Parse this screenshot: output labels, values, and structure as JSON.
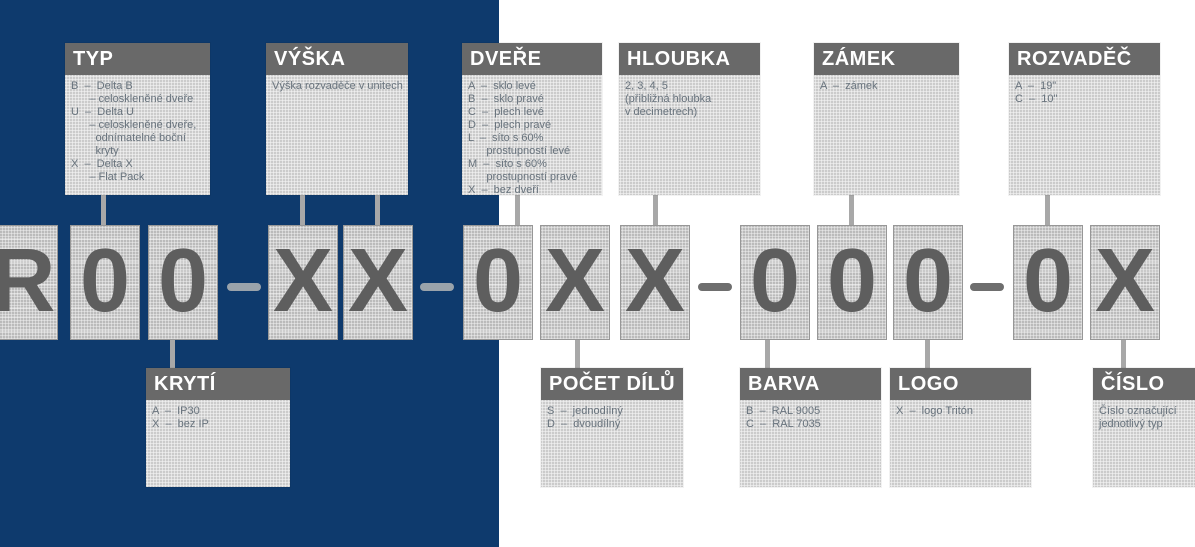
{
  "colors": {
    "background_left_panel": "#0e3a6d",
    "background_right": "#ffffff",
    "legend_header_bg": "#696969",
    "legend_header_text": "#ffffff",
    "legend_body_bg": "#d9d9d9",
    "legend_body_text": "#68737d",
    "code_box_bg": "#c9c9c9",
    "code_char": "#5e5e5e",
    "separator_on_blue": "#9aa3ab",
    "separator_on_white": "#6e6e6e",
    "connector": "#a8a8a8"
  },
  "legend_top": [
    {
      "title": "TYP",
      "lines": [
        "B  –  Delta B",
        "      – celoskleněné dveře",
        "U  –  Delta U",
        "      – celoskleněné dveře,",
        "        odnímatelné boční",
        "        kryty",
        "X  –  Delta X",
        "      – Flat Pack"
      ]
    },
    {
      "title": "VÝŠKA",
      "lines": [
        "Výška rozvaděče v unitech"
      ]
    },
    {
      "title": "DVEŘE",
      "lines": [
        "A  –  sklo levé",
        "B  –  sklo pravé",
        "C  –  plech levé",
        "D  –  plech pravé",
        "L  –  síto s 60%",
        "      prostupností levé",
        "M  –  síto s 60%",
        "      prostupností pravé",
        "X  –  bez dveří"
      ]
    },
    {
      "title": "HLOUBKA",
      "lines": [
        "2, 3, 4, 5",
        "(přibližná hloubka",
        "v decimetrech)"
      ]
    },
    {
      "title": "ZÁMEK",
      "lines": [
        "A  –  zámek"
      ]
    },
    {
      "title": "ROZVADĚČ",
      "lines": [
        "A  –  19\"",
        "C  –  10\""
      ]
    }
  ],
  "legend_bottom": [
    {
      "title": "KRYTÍ",
      "lines": [
        "A  –  IP30",
        "X  –  bez IP"
      ]
    },
    {
      "title": "POČET DÍLŮ",
      "lines": [
        "S  –  jednodílný",
        "D  –  dvoudílný"
      ]
    },
    {
      "title": "BARVA",
      "lines": [
        "B  –  RAL 9005",
        "C  –  RAL 7035"
      ]
    },
    {
      "title": "LOGO",
      "lines": [
        "X  –  logo Tritón"
      ]
    },
    {
      "title": "ČÍSLO",
      "lines": [
        "Číslo označující",
        "jednotlivý typ"
      ]
    }
  ],
  "code": {
    "characters": [
      "R",
      "0",
      "0",
      "X",
      "X",
      "0",
      "X",
      "X",
      "0",
      "0",
      "0",
      "0",
      "X"
    ],
    "separator": "–",
    "full_code": "R00–XX–0XX–000–0X"
  }
}
